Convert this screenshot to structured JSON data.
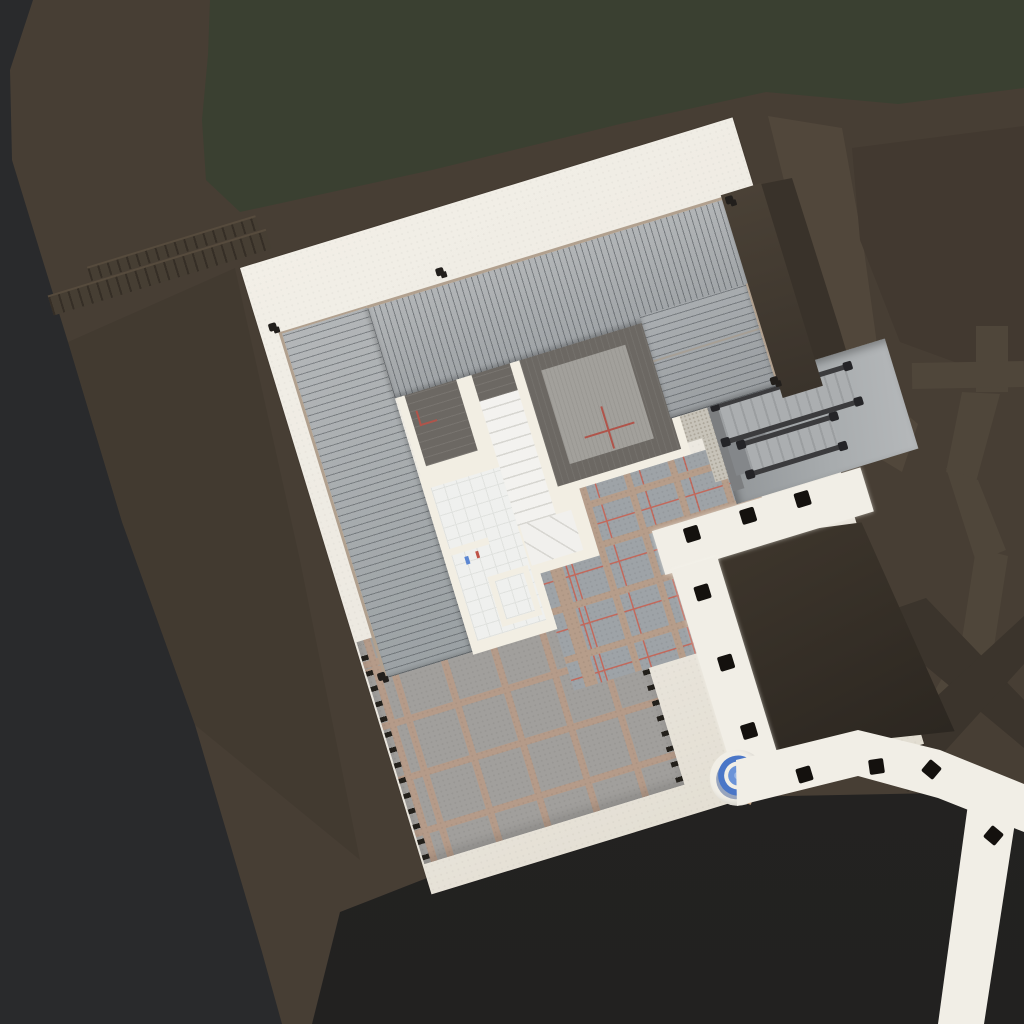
{
  "scene": {
    "type": "3D architectural site-plan render, orthographic top-down view",
    "site_rotation_deg": -17,
    "visible_text": "none"
  },
  "palette": {
    "meadow_green": "#3a4031",
    "terrain_brown": "#473e34",
    "terrain_path_light": "#51473b",
    "terrain_path_dark": "#3b342c",
    "terrain_patch": "#423930",
    "hillside_dark": "#292a2c",
    "ground_shadow": "#232221",
    "site_plate": "#ece8e0",
    "roof_gray": "#a8acae",
    "roof_line": "#8f9396",
    "roof_trim_tan": "#b1a08e",
    "deck_concrete": "#a7abad",
    "stair_rail": "#3b3b3d",
    "wall_cream": "#f2eee3",
    "floor_dark": "#6c6863",
    "floor_slab": "#a2a09b",
    "tile_white": "#eff0ee",
    "stair_tread_white": "#f3f2ef",
    "terrace_paver": "#9ea3a7",
    "terrace_beam": "#b69d8a",
    "terrace_guide_red": "#c2695c",
    "pergola_gray": "#a19f9c",
    "pergola_beam": "#b59b89",
    "garden_soil": "#3b342b",
    "walkway_white": "#f1eee6",
    "paver_marker_black": "#14110e",
    "umbrella_ring_blue": "#4a76c7",
    "umbrella_disc_blue": "#6b93d8",
    "umbrella_center_blue": "#9ab6e4",
    "fixture_blue": "#5b86d2",
    "fixture_red": "#bf5348",
    "plan_mark_red": "#b0544a"
  },
  "building": {
    "roof_sections": 3,
    "rooms": [
      "small-room",
      "main-room",
      "stair-well",
      "bathroom",
      "shower-room"
    ],
    "interior_stair_treads": 10,
    "exterior_stairs": {
      "upper_flight_steps": 13,
      "lower_flight_steps": 8
    }
  },
  "landscape": {
    "pergola_beam_grid": true,
    "walkway_markers": {
      "top_band": 3,
      "side_band": 3,
      "bottom_band": 3,
      "branch_band": 1
    },
    "umbrella": {
      "shape": "concentric circles",
      "rings": 3
    },
    "retaining_wall_ribs": 2
  }
}
